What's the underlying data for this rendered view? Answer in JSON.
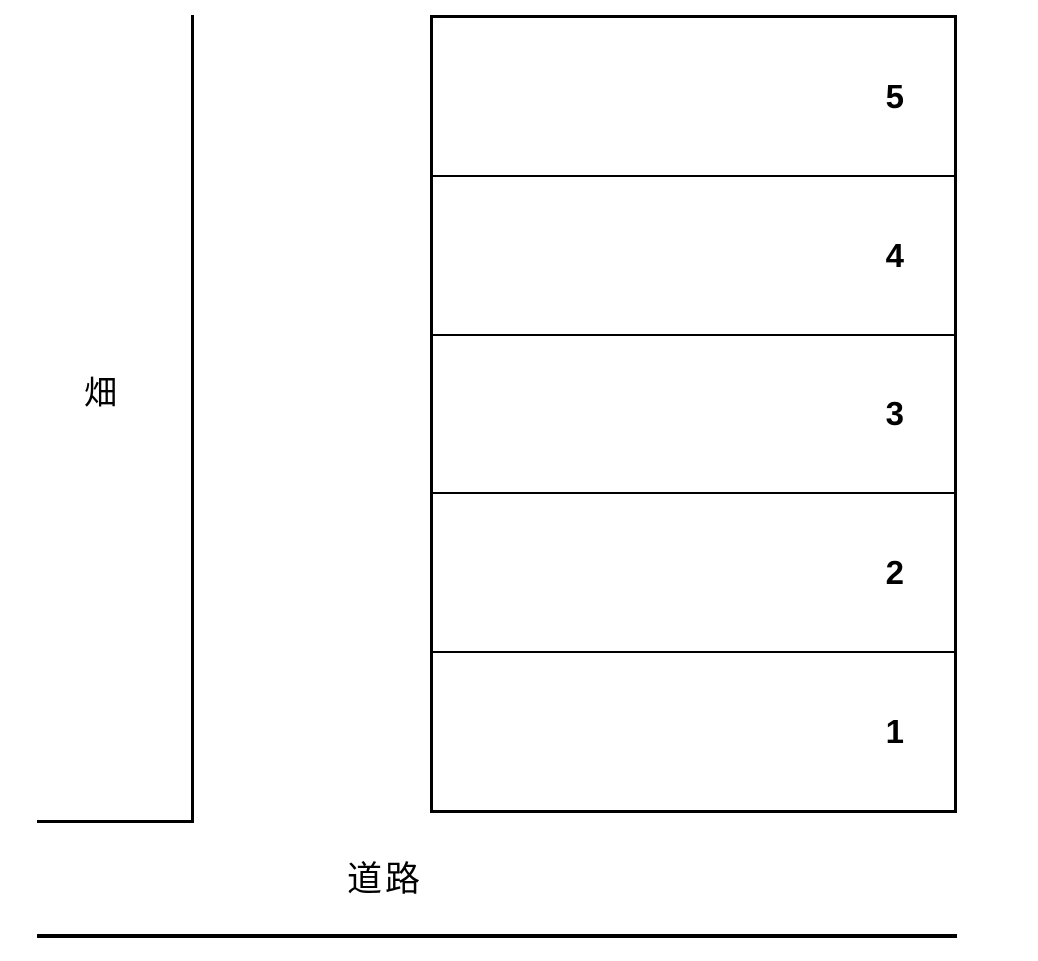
{
  "diagram": {
    "title": "parking-layout",
    "field": {
      "label": "畑"
    },
    "road": {
      "label": "道路"
    },
    "spaces": [
      {
        "number": "5"
      },
      {
        "number": "4"
      },
      {
        "number": "3"
      },
      {
        "number": "2"
      },
      {
        "number": "1"
      }
    ],
    "colors": {
      "line": "#000000",
      "background": "#ffffff",
      "text": "#000000"
    }
  }
}
